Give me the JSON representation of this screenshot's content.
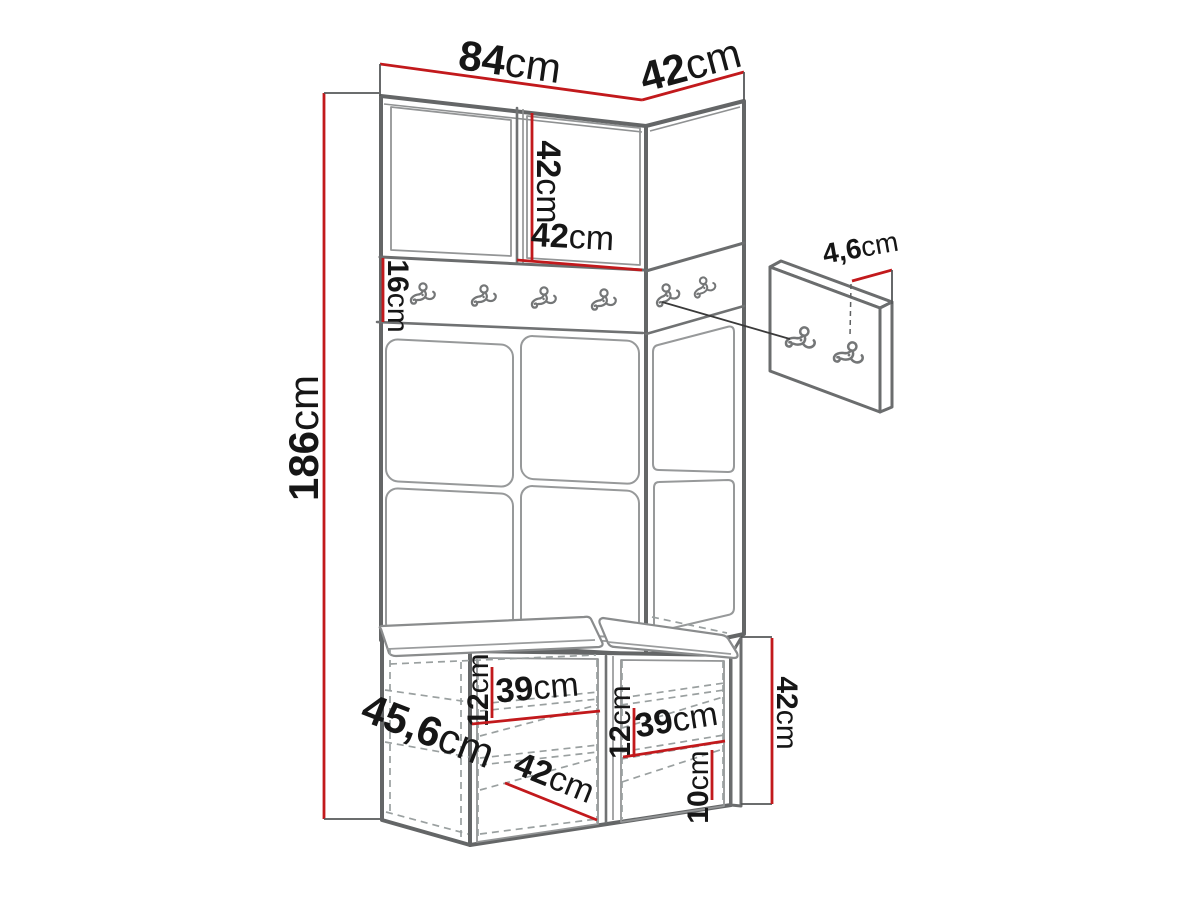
{
  "diagram": {
    "kind": "furniture dimension drawing",
    "subject": "hallway wardrobe set: top cabinet, coat-hook rail, upholstered wall panels, shoe bench with two seat cushions and separate wall hook panel",
    "units": "cm",
    "colors": {
      "background": "#ffffff",
      "dimension_line": "#c2191c",
      "outline": "#646667",
      "thin_line": "#97999a",
      "dashed_line": "#9aa0a0",
      "text": "#161616"
    },
    "hooks": {
      "rail_hook_count": 6,
      "side_panel_hook_count": 2
    },
    "dimensions": {
      "total_height": {
        "value": "186",
        "unit": "cm"
      },
      "top_width": {
        "value": "84",
        "unit": "cm"
      },
      "top_depth": {
        "value": "42",
        "unit": "cm"
      },
      "upper_door_height": {
        "value": "42",
        "unit": "cm"
      },
      "upper_door_width": {
        "value": "42",
        "unit": "cm"
      },
      "hook_rail_height": {
        "value": "16",
        "unit": "cm"
      },
      "side_panel_thickness": {
        "value": "4,6",
        "unit": "cm"
      },
      "bench_depth": {
        "value": "45,6",
        "unit": "cm"
      },
      "bench_height": {
        "value": "42",
        "unit": "cm"
      },
      "bench_left_shelf_spacing": {
        "value": "12",
        "unit": "cm"
      },
      "bench_left_compartment_width": {
        "value": "39",
        "unit": "cm"
      },
      "bench_right_shelf_spacing": {
        "value": "12",
        "unit": "cm"
      },
      "bench_right_compartment_width": {
        "value": "39",
        "unit": "cm"
      },
      "bench_bottom_shelf_height": {
        "value": "10",
        "unit": "cm"
      },
      "bench_diagonal_depth": {
        "value": "42",
        "unit": "cm"
      }
    }
  }
}
